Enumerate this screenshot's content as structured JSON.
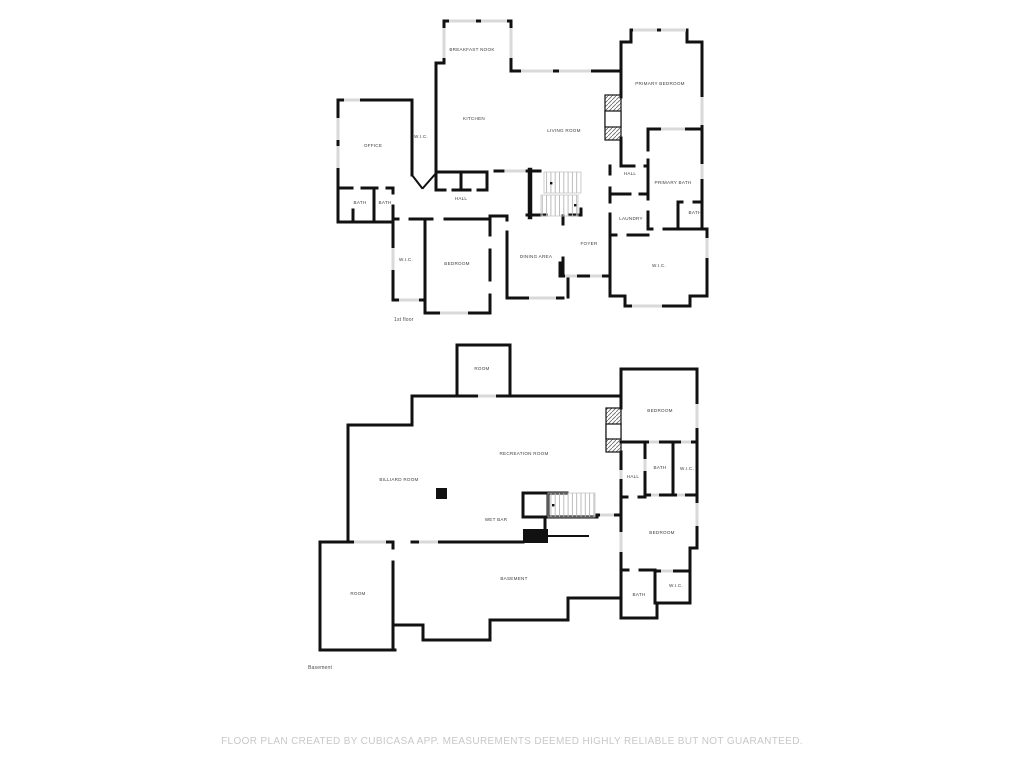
{
  "footer": {
    "text": "FLOOR PLAN CREATED BY CUBICASA APP. MEASUREMENTS DEEMED HIGHLY RELIABLE BUT NOT GUARANTEED."
  },
  "colors": {
    "wall": "#111111",
    "window": "#d9d9d9",
    "stair_tread": "#b5b5b5",
    "room_label": "#3e3e3e",
    "floor_label": "#4b4b4b",
    "footer_text": "#c8c8c8"
  },
  "icons": {
    "stairs": "parallel-tread-lines",
    "fireplace": "diagonal-hatch-rect",
    "billiard_table": "black-square-marker",
    "wet_bar_counter": "black-rect-marker"
  },
  "floors": [
    {
      "name": "1st floor",
      "rooms": [
        {
          "label": "BREAKFAST NOOK"
        },
        {
          "label": "KITCHEN"
        },
        {
          "label": "LIVING ROOM"
        },
        {
          "label": "PRIMARY BEDROOM"
        },
        {
          "label": "OFFICE"
        },
        {
          "label": "W.I.C."
        },
        {
          "label": "BATH"
        },
        {
          "label": "BATH"
        },
        {
          "label": "HALL"
        },
        {
          "label": "HALL"
        },
        {
          "label": "PRIMARY BATH"
        },
        {
          "label": "BATH"
        },
        {
          "label": "LAUNDRY"
        },
        {
          "label": "W.I.C."
        },
        {
          "label": "BEDROOM"
        },
        {
          "label": "DINING AREA"
        },
        {
          "label": "FOYER"
        },
        {
          "label": "W.I.C."
        }
      ]
    },
    {
      "name": "Basement",
      "rooms": [
        {
          "label": "ROOM"
        },
        {
          "label": "RECREATION ROOM"
        },
        {
          "label": "BILLIARD ROOM"
        },
        {
          "label": "BEDROOM"
        },
        {
          "label": "HALL"
        },
        {
          "label": "BATH"
        },
        {
          "label": "W.I.C."
        },
        {
          "label": "WET BAR"
        },
        {
          "label": "BASEMENT"
        },
        {
          "label": "ROOM"
        },
        {
          "label": "BEDROOM"
        },
        {
          "label": "BATH"
        },
        {
          "label": "W.I.C."
        }
      ]
    }
  ]
}
